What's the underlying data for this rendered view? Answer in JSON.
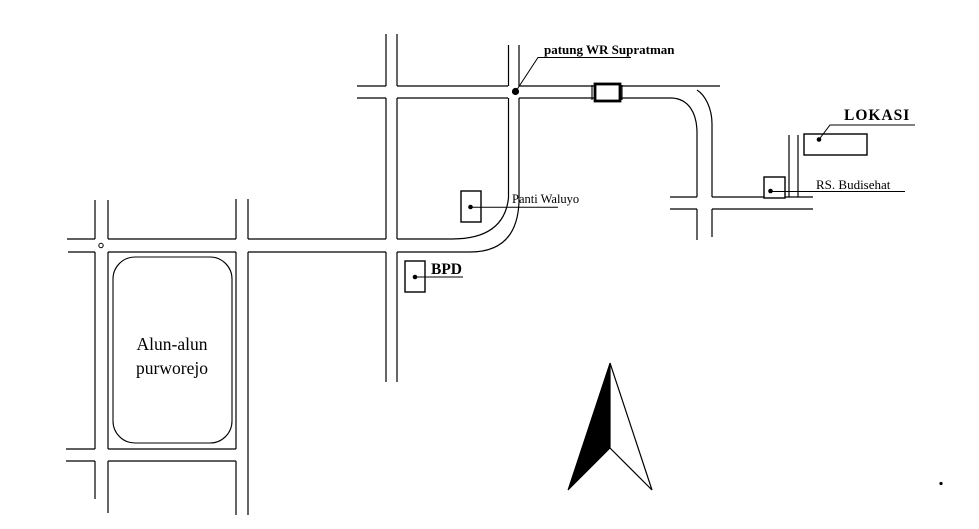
{
  "map": {
    "type": "location-sketch-map",
    "colors": {
      "ink": "#000000",
      "background": "#ffffff"
    },
    "labels": {
      "statue": "patung WR Supratman",
      "location": "LOKASI",
      "hospital": "RS. Budisehat",
      "care_home": "Panti Waluyo",
      "bank": "BPD",
      "square_line1": "Alun-alun",
      "square_line2": "purworejo"
    },
    "compass": {
      "direction": "north"
    }
  }
}
